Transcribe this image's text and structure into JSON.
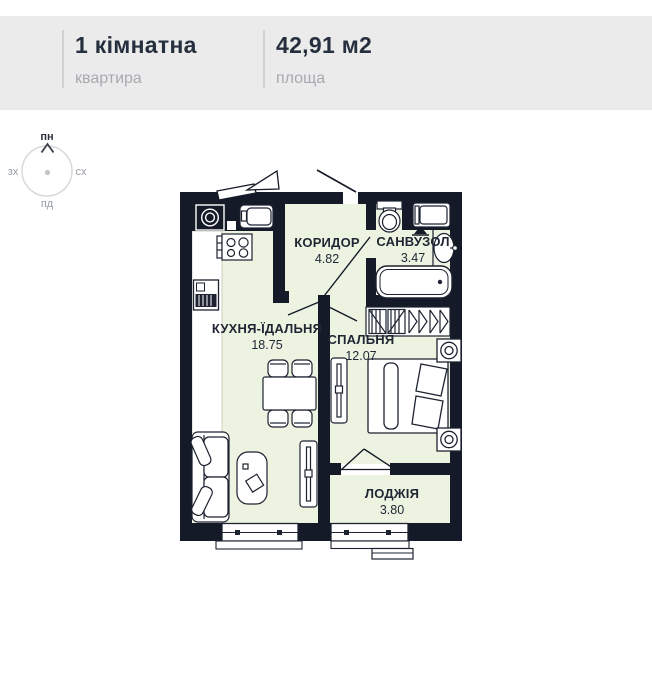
{
  "header": {
    "rooms_count_title": "1 кімнатна",
    "rooms_count_sub": "квартира",
    "area_title": "42,91 м2",
    "area_sub": "площа"
  },
  "compass": {
    "north": "пн",
    "south": "пд",
    "west": "зх",
    "east": "сх"
  },
  "rooms": [
    {
      "name": "КОРИДОР",
      "area": "4.82"
    },
    {
      "name": "САНВУЗОЛ",
      "area": "3.47"
    },
    {
      "name": "КУХНЯ-ЇДАЛЬНЯ",
      "area": "18.75"
    },
    {
      "name": "СПАЛЬНЯ",
      "area": "12.07"
    },
    {
      "name": "ЛОДЖІЯ",
      "area": "3.80"
    }
  ],
  "colors": {
    "wall": "#141a27",
    "room_fill": "#edf3e1",
    "header_bg": "#ebebeb",
    "text_dark": "#262f3d",
    "text_gray": "#a6aab0"
  }
}
